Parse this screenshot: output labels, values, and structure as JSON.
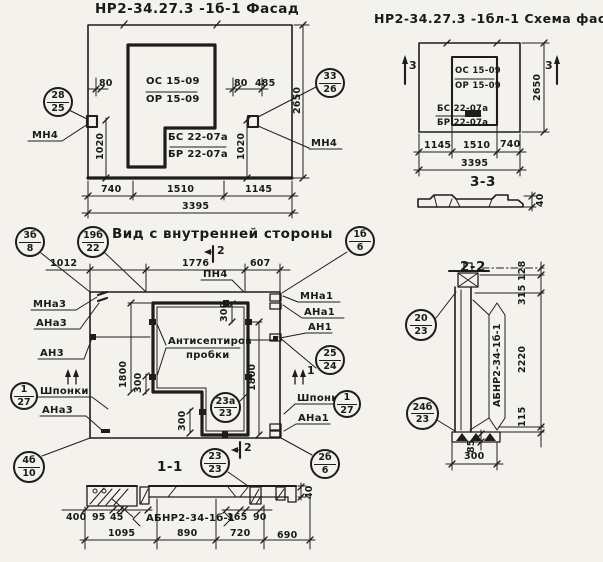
{
  "facade": {
    "title": "НР2-34.27.3 -1б-1 Фасад",
    "callout_left": {
      "top": "28",
      "bottom": "25"
    },
    "callout_right": {
      "top": "33",
      "bottom": "26"
    },
    "mn4_left": "МН4",
    "mn4_right": "МН4",
    "os": "ОС 15-09",
    "or": "ОР 15-09",
    "bs": "БС 22-07а",
    "br": "БР 22-07а",
    "d80l": "80",
    "d80r": "80",
    "d485": "485",
    "d1020l": "1020",
    "d1020r": "1020",
    "d2650": "2650",
    "d740": "740",
    "d1510": "1510",
    "d1145": "1145",
    "d3395": "3395"
  },
  "scheme": {
    "title": "НР2-34.27.3 -1бл-1 Схема фасада",
    "os": "ОС 15-09",
    "or": "ОР 15-09",
    "bs": "БС 22-07а",
    "br": "БР 22-07а",
    "mark_left": "3",
    "mark_right": "3",
    "d1145": "1145",
    "d1510": "1510",
    "d740": "740",
    "d3395": "3395",
    "d2650": "2650",
    "sec33_label": "3-3",
    "sec33_d40": "40"
  },
  "view": {
    "title": "Вид с внутренней стороны",
    "callout_3b8": {
      "top": "3б",
      "bottom": "8"
    },
    "callout_19b22": {
      "top": "19б",
      "bottom": "22"
    },
    "callout_1b6": {
      "top": "1б",
      "bottom": "6"
    },
    "callout_2524": {
      "top": "25",
      "bottom": "24"
    },
    "callout_127l": {
      "top": "1",
      "bottom": "27"
    },
    "callout_127r": {
      "top": "1",
      "bottom": "27"
    },
    "callout_23a23": {
      "top": "23а",
      "bottom": "23"
    },
    "callout_4b10": {
      "top": "4б",
      "bottom": "10"
    },
    "callout_2b6": {
      "top": "2б",
      "bottom": "6"
    },
    "callout_2323": {
      "top": "23",
      "bottom": "23"
    },
    "pn4": "ПН4",
    "mna3": "МНа3",
    "ana3": "АНа3",
    "an3": "АН3",
    "mna1": "МНа1",
    "ana1": "АНа1",
    "an1": "АН1",
    "shponki_l": "Шпонки",
    "shponki_r": "Шпонки",
    "ana3_b": "АНа3",
    "ana1_b": "АНа1",
    "antisept1": "Антисептиров",
    "antisept2": "пробки",
    "mark2_top": "2",
    "mark2_bottom": "2",
    "mark1_right": "1",
    "d1012": "1012",
    "d1776": "1776",
    "d607": "607",
    "d1800l": "1800",
    "d1800r": "1800",
    "d300t": "300",
    "d300l": "300",
    "d300b": "300"
  },
  "sec11": {
    "label": "1-1",
    "brand": "АБНР2-34-1б-1",
    "d400": "400",
    "d95": "95",
    "d45": "45",
    "d165": "165",
    "d90": "90",
    "d1095": "1095",
    "d890": "890",
    "d720": "720",
    "d690": "690",
    "d40": "40"
  },
  "sec22": {
    "label": "2-2",
    "brand": "АБНР2-34-1б-1",
    "callout_2023": {
      "top": "20",
      "bottom": "23"
    },
    "callout_24b23": {
      "top": "24б",
      "bottom": "23"
    },
    "d128": "128",
    "d315": "315",
    "d2220": "2220",
    "d115": "115",
    "d85": "85",
    "d300": "300"
  }
}
